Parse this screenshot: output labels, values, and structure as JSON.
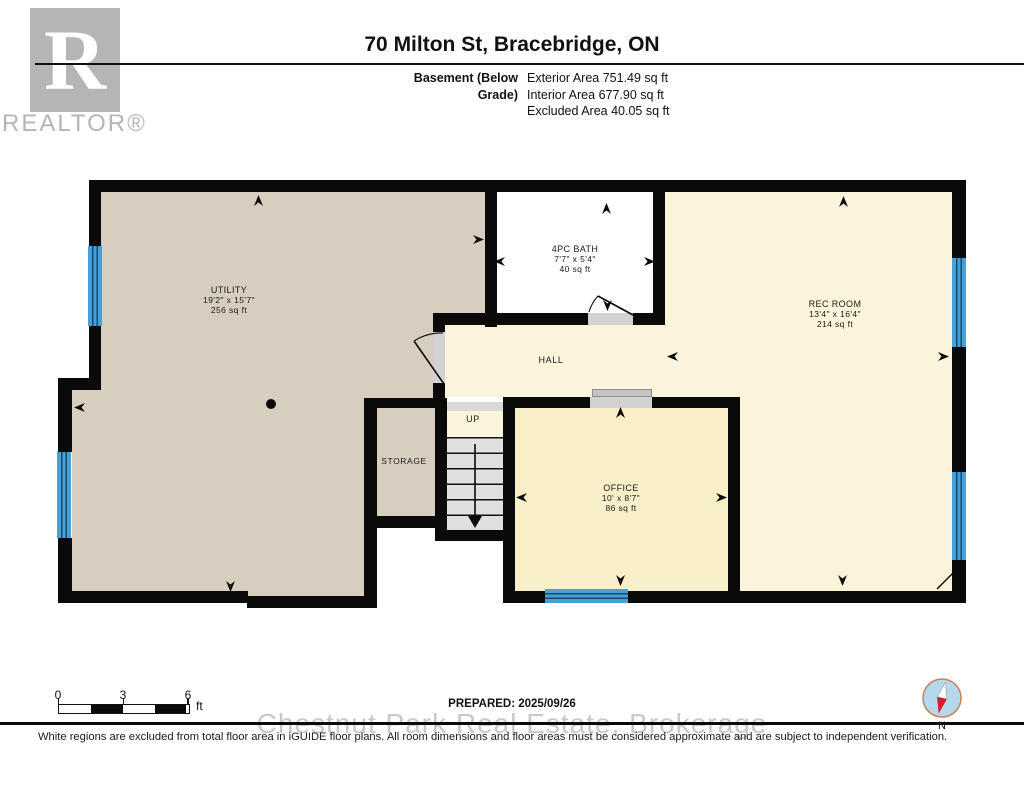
{
  "header": {
    "logo": {
      "letter": "R",
      "brand": "REALTOR®"
    },
    "title": "70 Milton St, Bracebridge, ON",
    "floor_label": "Basement (Below Grade)",
    "areas": [
      "Exterior Area 751.49 sq ft",
      "Interior Area 677.90 sq ft",
      "Excluded Area 40.05 sq ft"
    ]
  },
  "rooms": {
    "utility": {
      "name": "UTILITY",
      "dims": "19'2\" x 15'7\"",
      "area": "256 sq ft"
    },
    "bath": {
      "name": "4PC BATH",
      "dims": "7'7\" x 5'4\"",
      "area": "40 sq ft"
    },
    "rec_room": {
      "name": "REC ROOM",
      "dims": "13'4\" x 16'4\"",
      "area": "214 sq ft"
    },
    "office": {
      "name": "OFFICE",
      "dims": "10' x 8'7\"",
      "area": "86 sq ft"
    },
    "hall": {
      "name": "HALL"
    },
    "storage": {
      "name": "STORAGE"
    },
    "stairs": {
      "name": "UP"
    }
  },
  "footer": {
    "scale_ticks": [
      "0",
      "3",
      "6"
    ],
    "scale_unit": "ft",
    "prepared": "PREPARED: 2025/09/26",
    "watermark": "Chestnut Park Real Estate, Brokerage",
    "compass_north": "N",
    "disclaimer": "White regions are excluded from total floor area in iGUIDE floor plans. All room dimensions and floor areas must be considered approximate and are subject to independent verification."
  },
  "colors": {
    "wall": "#0a0a0a",
    "tan_room": "#d7cec0",
    "cream_room": "#fbf4da",
    "office_room": "#f8eec8",
    "window_blue": "#47a1d8",
    "window_line": "#1b4965",
    "stair_gray": "#e0e0e0",
    "logo_gray": "#b5b5b5"
  }
}
